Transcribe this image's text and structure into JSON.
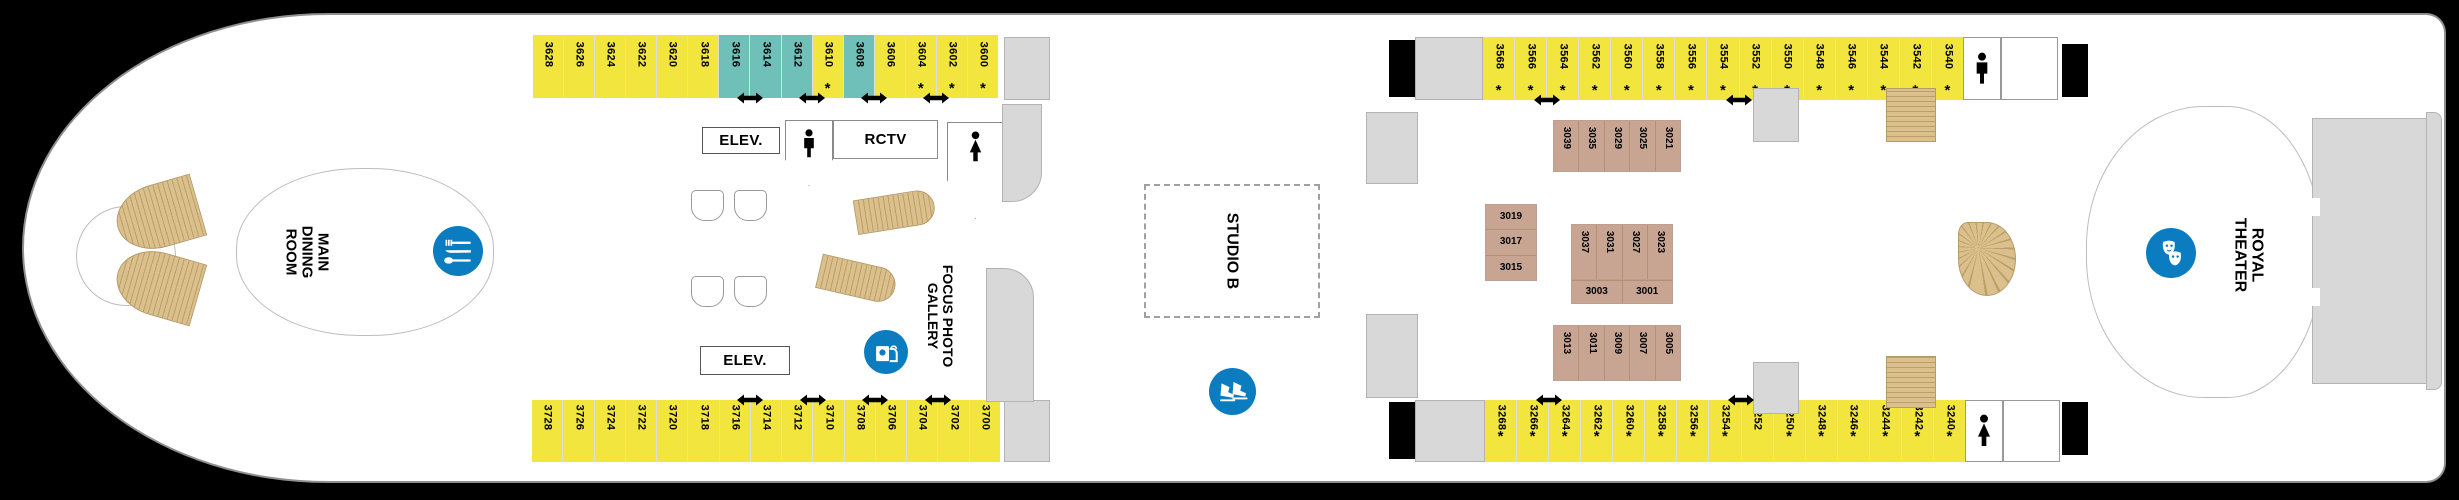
{
  "labels": {
    "main_dining_room": "MAIN\nDINING\nROOM",
    "elev_top": "ELEV.",
    "elev_bottom": "ELEV.",
    "rctv": "RCTV",
    "focus_photo_gallery": "FOCUS PHOTO\nGALLERY",
    "studio_b": "STUDIO B",
    "royal_theater": "ROYAL\nTHEATER",
    "star": "*"
  },
  "colors": {
    "cabin_yellow": "#F2E53E",
    "cabin_teal": "#6FC0B8",
    "cabin_rose": "#C8A593",
    "stair_tan": "#DBBF8C",
    "stair_tan_dark": "#BA9F66",
    "accent_blue": "#0B7CC0"
  },
  "icons": {
    "dining": "fork-knife-spoon",
    "photo_gallery": "shopping-bag-camera",
    "ice_skating": "ice-skates",
    "theater_masks": "comedy-tragedy-masks",
    "mens_restroom": "male-figure",
    "womens_restroom": "female-figure",
    "connecting_arrow": "double-headed-arrow"
  },
  "rows": {
    "top_left": {
      "cabins": [
        {
          "num": "3628"
        },
        {
          "num": "3626"
        },
        {
          "num": "3624"
        },
        {
          "num": "3622"
        },
        {
          "num": "3620"
        },
        {
          "num": "3618"
        },
        {
          "num": "3616",
          "teal": true
        },
        {
          "num": "3614",
          "teal": true
        },
        {
          "num": "3612",
          "teal": true
        },
        {
          "num": "3610",
          "star": true
        },
        {
          "num": "3608",
          "teal": true
        },
        {
          "num": "3606"
        },
        {
          "num": "3604",
          "star": true
        },
        {
          "num": "3602",
          "star": true
        },
        {
          "num": "3600",
          "star": true
        }
      ],
      "arrows_after": [
        6,
        8,
        10,
        12
      ]
    },
    "bottom_left": {
      "cabins": [
        {
          "num": "3728"
        },
        {
          "num": "3726"
        },
        {
          "num": "3724"
        },
        {
          "num": "3722"
        },
        {
          "num": "3720"
        },
        {
          "num": "3718"
        },
        {
          "num": "3716"
        },
        {
          "num": "3714"
        },
        {
          "num": "3712"
        },
        {
          "num": "3710"
        },
        {
          "num": "3708"
        },
        {
          "num": "3706"
        },
        {
          "num": "3704"
        },
        {
          "num": "3702"
        },
        {
          "num": "3700"
        }
      ],
      "arrows_after": [
        6,
        8,
        10,
        12
      ]
    },
    "top_right": {
      "cabins": [
        {
          "num": "3568",
          "star": true
        },
        {
          "num": "3566",
          "star": true
        },
        {
          "num": "3564",
          "star": true
        },
        {
          "num": "3562",
          "star": true
        },
        {
          "num": "3560",
          "star": true
        },
        {
          "num": "3558",
          "star": true
        },
        {
          "num": "3556",
          "star": true
        },
        {
          "num": "3554",
          "star": true
        },
        {
          "num": "3552",
          "star": true
        },
        {
          "num": "3550",
          "star": true
        },
        {
          "num": "3548",
          "star": true
        },
        {
          "num": "3546",
          "star": true
        },
        {
          "num": "3544",
          "star": true
        },
        {
          "num": "3542",
          "star": true
        },
        {
          "num": "3540",
          "star": true
        }
      ],
      "arrows_after": [
        1,
        7
      ]
    },
    "bottom_right": {
      "cabins": [
        {
          "num": "3268",
          "star": true
        },
        {
          "num": "3266",
          "star": true
        },
        {
          "num": "3264",
          "star": true
        },
        {
          "num": "3262",
          "star": true
        },
        {
          "num": "3260",
          "star": true
        },
        {
          "num": "3258",
          "star": true
        },
        {
          "num": "3256",
          "star": true
        },
        {
          "num": "3254",
          "star": true
        },
        {
          "num": "3252"
        },
        {
          "num": "3250",
          "star": true
        },
        {
          "num": "3248",
          "star": true
        },
        {
          "num": "3246",
          "star": true
        },
        {
          "num": "3244",
          "star": true
        },
        {
          "num": "3242",
          "star": true
        },
        {
          "num": "3240",
          "star": true
        }
      ],
      "arrows_after": [
        1,
        7
      ]
    }
  },
  "inner": {
    "top": [
      "3039",
      "3035",
      "3029",
      "3025",
      "3021"
    ],
    "left": [
      "3019",
      "3017",
      "3015"
    ],
    "mid_v": [
      "3037",
      "3031",
      "3027",
      "3023"
    ],
    "mid_h": [
      "3003",
      "3001"
    ],
    "bottom": [
      "3013",
      "3011",
      "3009",
      "3007",
      "3005"
    ]
  }
}
